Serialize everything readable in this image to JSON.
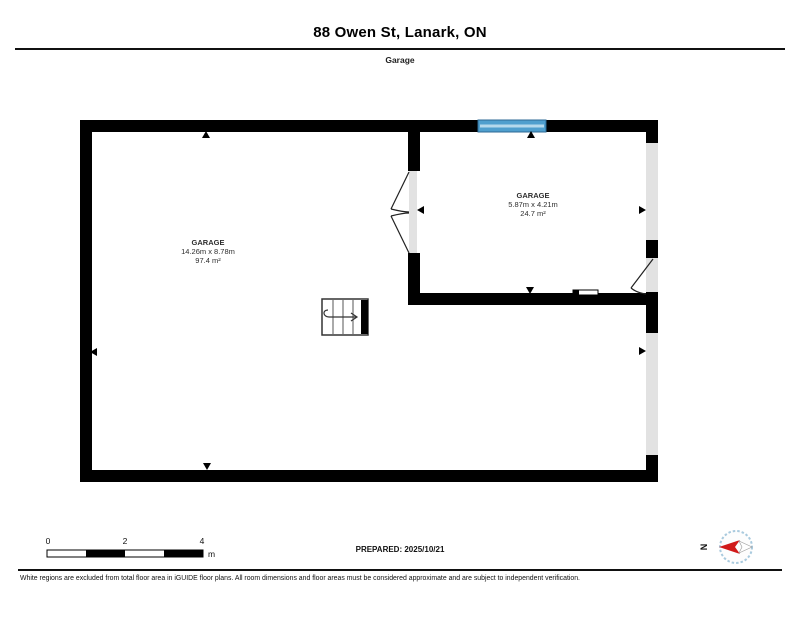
{
  "header": {
    "title": "88 Owen St, Lanark, ON",
    "floor_label": "Garage"
  },
  "plan": {
    "rooms": [
      {
        "name": "GARAGE",
        "dimensions": "14.26m x 8.78m",
        "area": "97.4 m²"
      },
      {
        "name": "GARAGE",
        "dimensions": "5.87m x 4.21m",
        "area": "24.7 m²"
      }
    ]
  },
  "scale_bar": {
    "ticks": [
      "0",
      "2",
      "4"
    ],
    "unit": "m"
  },
  "prepared_label": "PREPARED: 2025/10/21",
  "compass": {
    "north_label": "N"
  },
  "disclaimer": "White regions are excluded from total floor area in iGUIDE floor plans. All room dimensions and floor areas must be considered approximate and are subject to independent verification.",
  "colors": {
    "wall": "#000000",
    "window_blue": "#4f9fce",
    "window_stripe": "#b5d9ec",
    "opening_gray": "#e2e2e2",
    "compass_red": "#d11a1a",
    "compass_ring": "#a9cade"
  }
}
